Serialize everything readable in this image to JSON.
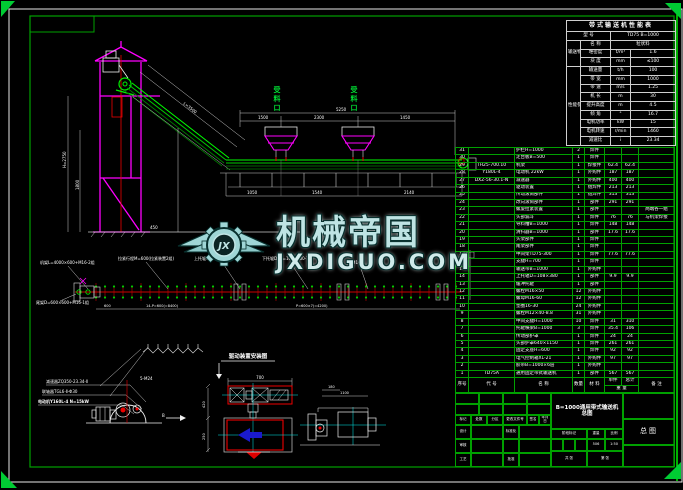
{
  "watermark": {
    "logo_text": "JX",
    "title": "机械帝国",
    "url": "JXDIGUO.COM"
  },
  "drawing": {
    "feed1": "受料口",
    "feed2": "受料口",
    "seg1": "1500",
    "seg2": "2300",
    "seg3": "1450",
    "total": "5250",
    "incline": "L=3500",
    "h1": "H=2750",
    "h2": "1800",
    "g450": "450",
    "c1": "1050",
    "c2": "1540",
    "c3": "2140",
    "p1": "机架L=4000×600+M16-2组",
    "p2": "拉紧行程M=600(拉紧装置2组)",
    "p3": "上托辊GX108×380-20组",
    "p4": "下托辊D×L=108×380-7组",
    "p5": "尾架D=600×600+M16-1组",
    "p6": "4-M16",
    "pd1": "14-P=600(=8400)",
    "pd2": "P=600×7(=4200)",
    "pd3": "600",
    "dr1": "减速器ZQ350-23.34-Ⅱ",
    "dr2": "联轴器TGL6-Ⅱ-Φ30",
    "dr3": "电动机Y160L-4 N=15kW",
    "dr_small": "5-M24",
    "dir": "B",
    "inst_title": "驱动装置安装图",
    "inst_w": "700",
    "inst_h1": "420",
    "inst_h2": "250",
    "pul1": "180",
    "pul2": "1100"
  },
  "perf_table": {
    "rows": [
      [
        {
          "t": "带式输送机性能表",
          "cs": 4,
          "cl": "ttl"
        }
      ],
      [
        {
          "t": "型 号",
          "cs": 2
        },
        {
          "t": "TD75 B=1000",
          "cs": 2
        }
      ],
      [
        {
          "t": "输送物料",
          "rs": 3
        },
        {
          "t": "名 称"
        },
        {
          "t": "粒状料",
          "cs": 2
        }
      ],
      [
        {
          "t": "堆密度"
        },
        {
          "t": "t/m³"
        },
        {
          "t": "1.6"
        }
      ],
      [
        {
          "t": "块 度"
        },
        {
          "t": "mm"
        },
        {
          "t": "≤100"
        }
      ],
      [
        {
          "t": "性能参数",
          "rs": 9
        },
        {
          "t": "输送量"
        },
        {
          "t": "t/h"
        },
        {
          "t": "100"
        }
      ],
      [
        {
          "t": "带 宽"
        },
        {
          "t": "mm"
        },
        {
          "t": "1000"
        }
      ],
      [
        {
          "t": "带 速"
        },
        {
          "t": "m/s"
        },
        {
          "t": "1.25"
        }
      ],
      [
        {
          "t": "机 长"
        },
        {
          "t": "m"
        },
        {
          "t": "30"
        }
      ],
      [
        {
          "t": "提升高度"
        },
        {
          "t": "m"
        },
        {
          "t": "4.5"
        }
      ],
      [
        {
          "t": "倾 角"
        },
        {
          "t": "°"
        },
        {
          "t": "16.7"
        }
      ],
      [
        {
          "t": "电机功率"
        },
        {
          "t": "kW"
        },
        {
          "t": "15"
        }
      ],
      [
        {
          "t": "电机转速"
        },
        {
          "t": "r/min"
        },
        {
          "t": "1460"
        }
      ],
      [
        {
          "t": "减速比"
        },
        {
          "t": "i"
        },
        {
          "t": "23.34"
        }
      ]
    ],
    "col_widths": [
      14,
      30,
      20,
      45
    ]
  },
  "bom_table": {
    "col_widths": [
      13,
      46,
      58,
      12,
      20,
      17,
      17,
      36
    ],
    "items": [
      [
        "31",
        "",
        "护栏H=1000",
        "2",
        "焊件",
        "",
        "",
        ""
      ],
      [
        "30",
        "",
        "走台板B=500",
        "1",
        "焊件",
        "",
        "",
        ""
      ],
      [
        "29",
        "TH25-700.10",
        "机架",
        "1",
        "焊接件",
        "62.4",
        "62.4",
        ""
      ],
      [
        "28",
        "Y180L-4",
        "电动机 22kW",
        "1",
        "外购件",
        "187",
        "187",
        ""
      ],
      [
        "27",
        "DXZ-56-30.1-N",
        "减速器",
        "1",
        "外购件",
        "400",
        "400",
        ""
      ],
      [
        "26",
        "",
        "驱动装置",
        "1",
        "组焊件",
        "213",
        "213",
        ""
      ],
      [
        "25",
        "",
        "传动滚筒部件",
        "1",
        "组焊件",
        "313",
        "313",
        ""
      ],
      [
        "24",
        "",
        "改向滚筒部件",
        "1",
        "部件",
        "291",
        "291",
        ""
      ],
      [
        "23",
        "",
        "螺旋拉紧装置",
        "1",
        "部件",
        "",
        "",
        "两端各一组"
      ],
      [
        "22",
        "",
        "头部漏斗",
        "1",
        "焊件",
        "76",
        "76",
        "与机架焊接"
      ],
      [
        "21",
        "",
        "导料槽B=1000",
        "1",
        "焊件",
        "148",
        "148",
        ""
      ],
      [
        "20",
        "",
        "清扫器B=1000",
        "1",
        "部件",
        "17.6",
        "17.6",
        ""
      ],
      [
        "19",
        "",
        "头架部件",
        "1",
        "焊件",
        "",
        "",
        ""
      ],
      [
        "18",
        "",
        "尾架部件",
        "1",
        "焊件",
        "",
        "",
        ""
      ],
      [
        "17",
        "",
        "中间架TD75-300",
        "1",
        "焊件",
        "77.6",
        "77.6",
        ""
      ],
      [
        "16",
        "",
        "支腿H=700",
        "1",
        "焊件",
        "",
        "",
        ""
      ],
      [
        "15",
        "",
        "输送带B=1000",
        "1",
        "外购件",
        "",
        "",
        ""
      ],
      [
        "14",
        "",
        "上托辊D=108×380",
        "1",
        "部件",
        "9.9",
        "9.9",
        ""
      ],
      [
        "13",
        "",
        "缓冲托辊",
        "1",
        "部件",
        "",
        "",
        ""
      ],
      [
        "12",
        "",
        "螺栓M16×50",
        "12",
        "外购件",
        "",
        "",
        ""
      ],
      [
        "11",
        "",
        "螺母M16-60",
        "12",
        "外购件",
        "",
        "",
        ""
      ],
      [
        "10",
        "",
        "垫圈16-30",
        "24",
        "外购件",
        "",
        "",
        ""
      ],
      [
        "9",
        "",
        "螺栓M12×40-8.8",
        "31",
        "外购件",
        "",
        "",
        ""
      ],
      [
        "8",
        "",
        "中间支腿H=1000",
        "10",
        "焊件",
        "31",
        "310",
        ""
      ],
      [
        "7",
        "",
        "托辊横梁B=1000",
        "3",
        "焊件",
        "35.4",
        "106",
        ""
      ],
      [
        "6",
        "",
        "传动部护罩",
        "1",
        "焊件",
        "24",
        "24",
        ""
      ],
      [
        "5",
        "",
        "头部护罩640×1150",
        "1",
        "焊件",
        "261",
        "261",
        ""
      ],
      [
        "4",
        "",
        "固定支座H=600",
        "1",
        "焊件",
        "92",
        "92",
        ""
      ],
      [
        "3",
        "",
        "电气控制箱XL-21",
        "1",
        "外购件",
        "97",
        "97",
        ""
      ],
      [
        "2",
        "",
        "胶带B=1000×6层",
        "1",
        "外购件",
        "",
        "",
        ""
      ],
      [
        "1",
        "TD75A",
        "通用固定带式输送机",
        "1",
        "部件",
        "567",
        "567",
        ""
      ]
    ],
    "header1": [
      "序号",
      "代 号",
      "名 称",
      "数量",
      "材 料",
      "单件",
      "总计",
      "备 注"
    ],
    "header2": "重 量"
  },
  "title_block": {
    "mark": "标记",
    "count": "处数",
    "zone": "分区",
    "doc_no": "更改文件号",
    "sign": "签名",
    "date": "年月日",
    "design": "设计",
    "standard": "标准化",
    "check": "审核",
    "process": "工艺",
    "approve": "批准",
    "title": "B=1000通用带式输送机总图",
    "stage": "阶段标记",
    "weight_label": "重量",
    "scale_label": "比例",
    "weight": "506",
    "scale": "1:50",
    "sheet_total": "共 张",
    "sheet_no": "第 张",
    "type": "总图"
  }
}
